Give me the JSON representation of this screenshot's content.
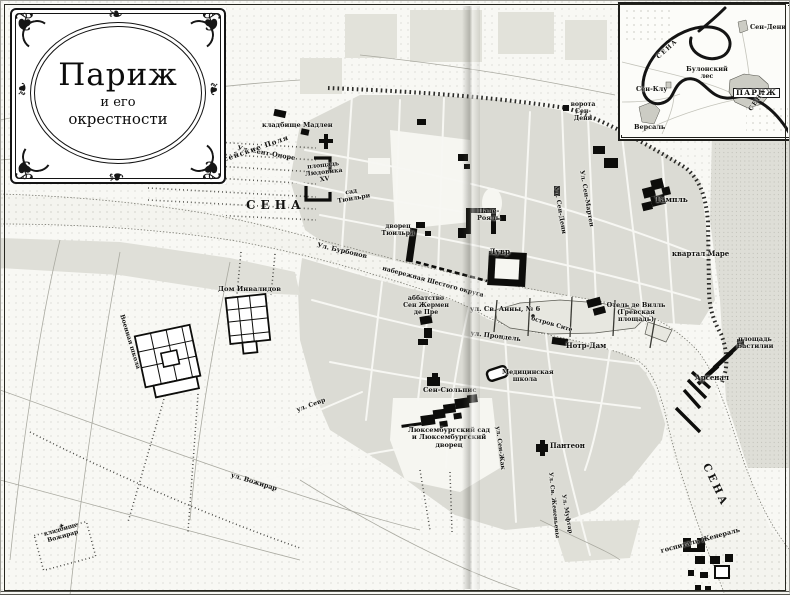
{
  "palette": {
    "paper": "#f8f8f4",
    "ink": "#111111",
    "built_block": "#dbdbd4",
    "river": "#f4f4ef",
    "wall": "#2b2b28"
  },
  "cartouche": {
    "title": "Париж",
    "line2": "и его",
    "line3": "окрестности"
  },
  "inset": {
    "labels": [
      {
        "id": "sen-deni",
        "text": "Сен-Дени"
      },
      {
        "id": "sena-loop",
        "text": "СЕНА"
      },
      {
        "id": "bulonskiy-les",
        "text": "Булонский лес"
      },
      {
        "id": "sen-klu",
        "text": "Сен-Клу"
      },
      {
        "id": "parizh",
        "text": "ПАРИЖ"
      },
      {
        "id": "sena-se",
        "text": "СЕНА"
      },
      {
        "id": "versal",
        "text": "Версаль"
      }
    ]
  },
  "map": {
    "symbols": {
      "cemetery_cross": "✝"
    },
    "labels": [
      {
        "id": "madeleine-cemetery",
        "text": "кладбище Мадлен"
      },
      {
        "id": "rue-st-honore",
        "text": "Ул. Сент-Оноре"
      },
      {
        "id": "champs-elysees",
        "text": "Елисейские Поля"
      },
      {
        "id": "place-louis-xv",
        "text": "площадь Людовика XV"
      },
      {
        "id": "tuileries-garden",
        "text": "сад Тюильри"
      },
      {
        "id": "seine-west",
        "text": "СЕНА"
      },
      {
        "id": "rue-bourbon",
        "text": "Ул. Бурбонов"
      },
      {
        "id": "tuileries-palace",
        "text": "дворец Тюильри"
      },
      {
        "id": "palais-royal",
        "text": "Пале-Рояль"
      },
      {
        "id": "louvre",
        "text": "Лувр"
      },
      {
        "id": "rue-st-denis",
        "text": "Ул. Сен-Дени"
      },
      {
        "id": "rue-st-martin",
        "text": "Ул. Сен-Мартен"
      },
      {
        "id": "porte-st-denis",
        "text": "ворота Сен-Дени"
      },
      {
        "id": "temple",
        "text": "Тампль"
      },
      {
        "id": "marais",
        "text": "квартал Маре"
      },
      {
        "id": "quai-sixth",
        "text": "набережная Шестого округа"
      },
      {
        "id": "st-germain-abbey",
        "text": "аббатство Сен Жермен де Пре"
      },
      {
        "id": "rue-st-anne-6",
        "text": "ул. Св. Анны, № 6"
      },
      {
        "id": "ile-cite",
        "text": "остров Сите"
      },
      {
        "id": "rue-prondel",
        "text": "ул. Прондель"
      },
      {
        "id": "notre-dame",
        "text": "Нотр-Дам"
      },
      {
        "id": "hotel-de-ville",
        "text": "Отель де Вилль (Гревская площадь)"
      },
      {
        "id": "bastille-square",
        "text": "площадь Бастилии"
      },
      {
        "id": "arsenal",
        "text": "Арсенал"
      },
      {
        "id": "invalides",
        "text": "Дом Инвалидов"
      },
      {
        "id": "military-school",
        "text": "Военная школа"
      },
      {
        "id": "medical-school",
        "text": "Медицинская школа"
      },
      {
        "id": "st-sulpice",
        "text": "Сен-Сюльпис"
      },
      {
        "id": "luxembourg",
        "text": "Люксембургский сад и Люксембургский дворец"
      },
      {
        "id": "rue-sevres",
        "text": "ул. Севр"
      },
      {
        "id": "rue-st-jacques",
        "text": "ул. Сен-Жак"
      },
      {
        "id": "pantheon",
        "text": "Пантеон"
      },
      {
        "id": "rue-vaugirard",
        "text": "ул. Вожирар"
      },
      {
        "id": "vaugirard-cemetery",
        "text": "кладбище Вожирар"
      },
      {
        "id": "rue-ste-genevieve",
        "text": "Ул. Св. Женевьевы"
      },
      {
        "id": "rue-mouffetard",
        "text": "Ул. Муфтар"
      },
      {
        "id": "seine-east",
        "text": "СЕНА"
      },
      {
        "id": "hopital-general",
        "text": "госпиталь Женераль"
      }
    ]
  }
}
